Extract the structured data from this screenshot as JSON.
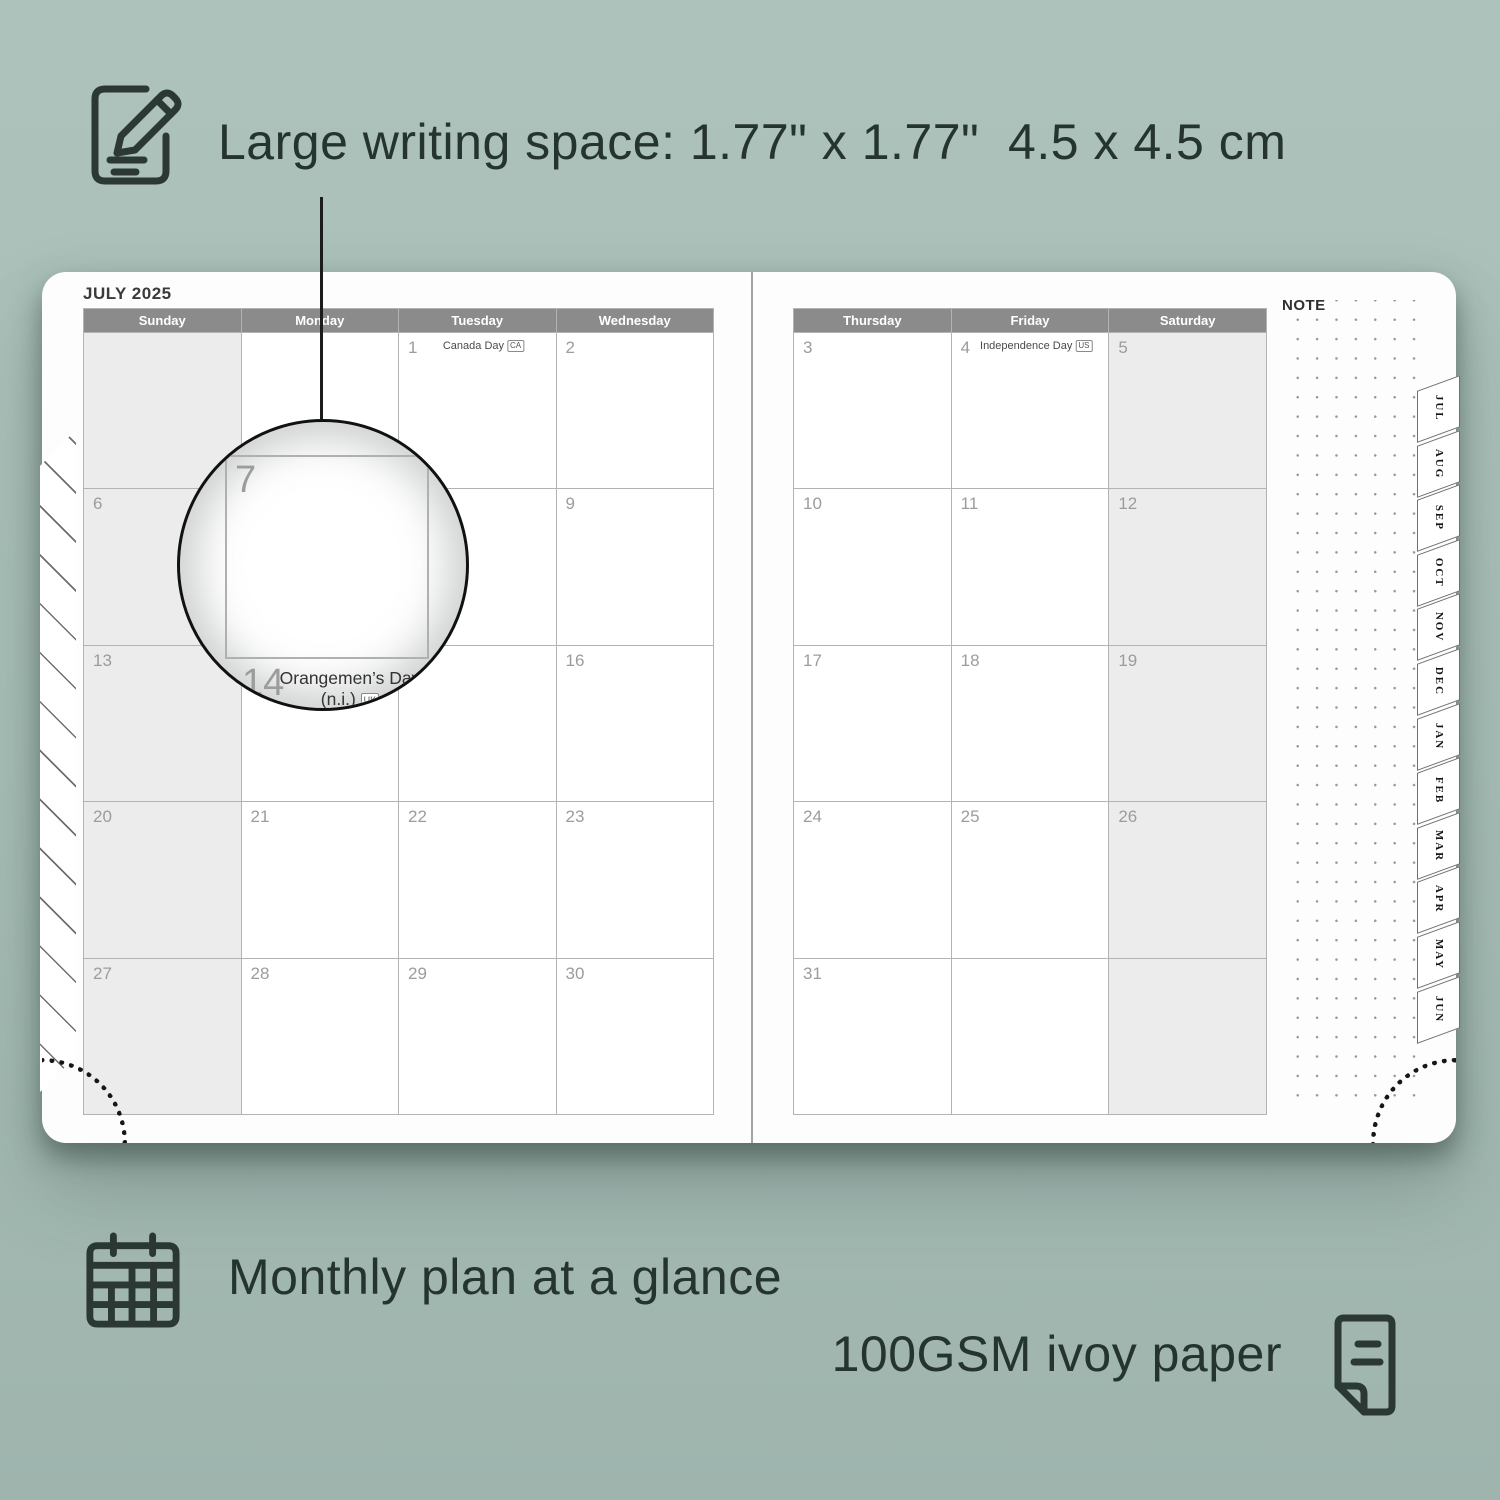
{
  "features": {
    "writing_space": "Large writing space: 1.77\" x 1.77\"  4.5 x 4.5 cm",
    "monthly_plan": "Monthly plan at a glance",
    "paper": "100GSM ivoy paper"
  },
  "planner": {
    "month_title": "JULY 2025",
    "note_label": "NOTE",
    "left_page": {
      "weekdays": [
        "Sunday",
        "Monday",
        "Tuesday",
        "Wednesday"
      ],
      "shaded_column": 0,
      "cells": [
        [
          {
            "day": ""
          },
          {
            "day": ""
          },
          {
            "day": "1",
            "holiday": "Canada Day",
            "tag": "CA"
          },
          {
            "day": "2"
          }
        ],
        [
          {
            "day": "6"
          },
          {
            "day": "7"
          },
          {
            "day": "8"
          },
          {
            "day": "9"
          }
        ],
        [
          {
            "day": "13"
          },
          {
            "day": "14",
            "holiday": "Orangemen’s Day (n.i.)",
            "tag": "UK"
          },
          {
            "day": "15"
          },
          {
            "day": "16"
          }
        ],
        [
          {
            "day": "20"
          },
          {
            "day": "21"
          },
          {
            "day": "22"
          },
          {
            "day": "23"
          }
        ],
        [
          {
            "day": "27"
          },
          {
            "day": "28"
          },
          {
            "day": "29"
          },
          {
            "day": "30"
          }
        ]
      ]
    },
    "right_page": {
      "weekdays": [
        "Thursday",
        "Friday",
        "Saturday"
      ],
      "shaded_column": 2,
      "cells": [
        [
          {
            "day": "3"
          },
          {
            "day": "4",
            "holiday": "Independence Day",
            "tag": "US"
          },
          {
            "day": "5"
          }
        ],
        [
          {
            "day": "10"
          },
          {
            "day": "11"
          },
          {
            "day": "12"
          }
        ],
        [
          {
            "day": "17"
          },
          {
            "day": "18"
          },
          {
            "day": "19"
          }
        ],
        [
          {
            "day": "24"
          },
          {
            "day": "25"
          },
          {
            "day": "26"
          }
        ],
        [
          {
            "day": "31"
          },
          {
            "day": ""
          },
          {
            "day": ""
          }
        ]
      ]
    },
    "tabs": [
      "JUL",
      "AUG",
      "SEP",
      "OCT",
      "NOV",
      "DEC",
      "JAN",
      "FEB",
      "MAR",
      "APR",
      "MAY",
      "JUN"
    ]
  },
  "magnifier": {
    "day": "7",
    "next_day": "14",
    "holiday_line1": "Orangemen’s Day",
    "holiday_line2": "(n.i.)",
    "holiday_tag": "UK"
  },
  "colors": {
    "background_sage": "#a7beb6",
    "ink_dark": "#263430",
    "header_gray": "#8b8b8b",
    "shaded_cell": "#ececec",
    "day_number_gray": "#9c9c9c"
  }
}
